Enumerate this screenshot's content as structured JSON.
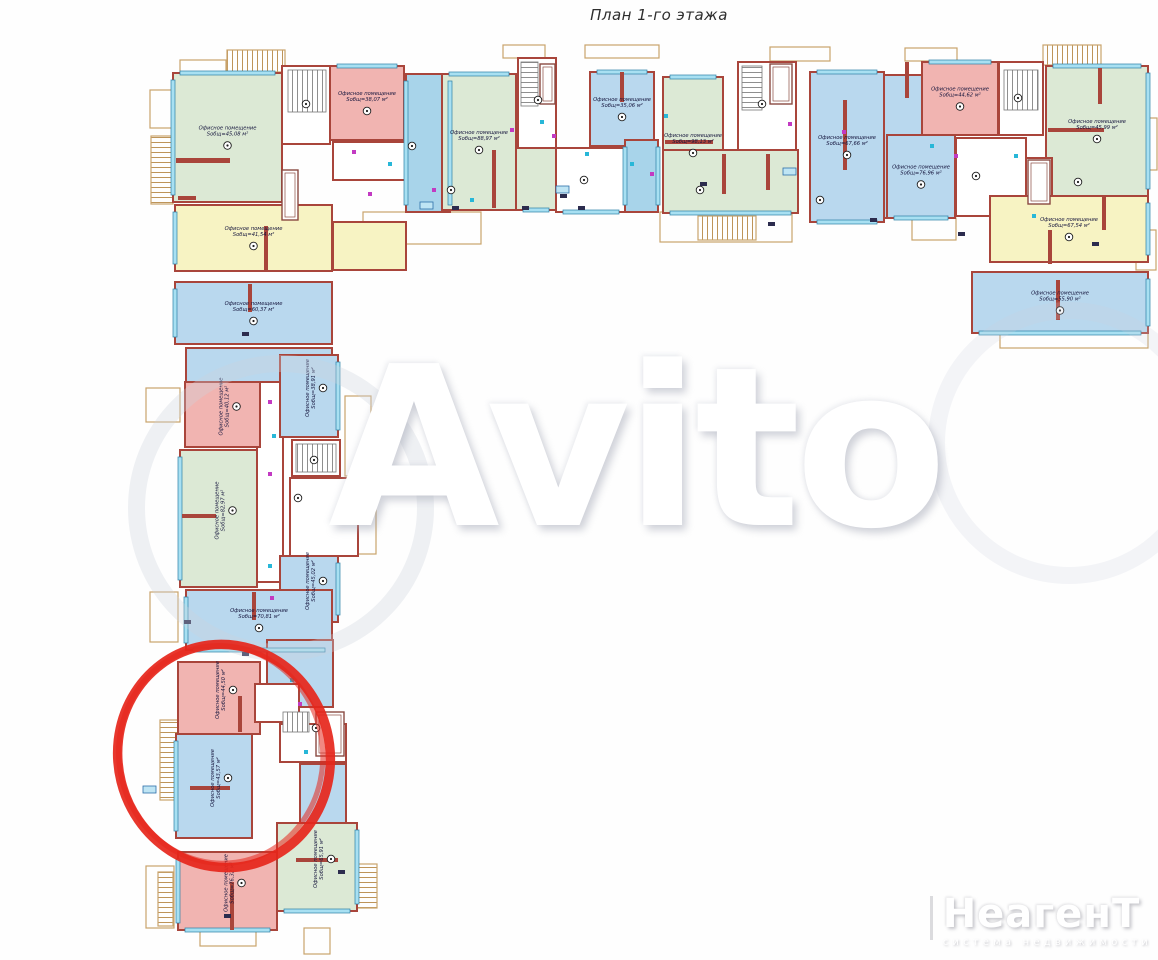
{
  "title": "План 1-го этажа",
  "watermark": {
    "text": "Avito"
  },
  "logo": {
    "brand": "НеагенТ",
    "subtitle": "система недвижимости"
  },
  "labels": {
    "room_type": "Офисное помещение",
    "area_prefix": "Sобщ=",
    "area_suffix": " м²"
  },
  "palette": {
    "wall": "#a9453b",
    "tan": "#c9a36b",
    "window": "#a8e0f2",
    "windowEdge": "#2d7fa6",
    "green": "#dce9d5",
    "blue": "#b9d8ee",
    "gal": "#a8d4ea",
    "pink": "#f1b4b1",
    "yellow": "#f7f3c3",
    "white": "#ffffff",
    "fix1": "#c23ac2",
    "fix2": "#28b7d8",
    "annotation": "#e6261b"
  },
  "plan": {
    "rooms": [
      {
        "id": "g1",
        "x": 173,
        "y": 73,
        "w": 109,
        "h": 129,
        "c": "green",
        "area": "45,08",
        "win": [
          "left",
          "top"
        ]
      },
      {
        "id": "y1",
        "x": 175,
        "y": 205,
        "w": 157,
        "h": 66,
        "c": "yellow",
        "area": "41,54",
        "win": [
          "left"
        ]
      },
      {
        "id": "core1",
        "x": 282,
        "y": 66,
        "w": 48,
        "h": 78,
        "c": "white"
      },
      {
        "id": "wc1",
        "x": 333,
        "y": 142,
        "w": 72,
        "h": 38,
        "c": "white"
      },
      {
        "id": "y1b",
        "x": 333,
        "y": 222,
        "w": 73,
        "h": 48,
        "c": "yellow"
      },
      {
        "id": "p1",
        "x": 330,
        "y": 66,
        "w": 74,
        "h": 74,
        "c": "pink",
        "area": "38,07",
        "win": [
          "top"
        ]
      },
      {
        "id": "gal1",
        "x": 406,
        "y": 74,
        "w": 44,
        "h": 138,
        "c": "gal",
        "win": [
          "left",
          "right"
        ]
      },
      {
        "id": "g2",
        "x": 442,
        "y": 74,
        "w": 74,
        "h": 136,
        "c": "green",
        "area": "88,97",
        "win": [
          "top"
        ]
      },
      {
        "id": "g2b",
        "x": 516,
        "y": 148,
        "w": 40,
        "h": 62,
        "c": "green",
        "win": [
          "bottom"
        ]
      },
      {
        "id": "core2",
        "x": 518,
        "y": 58,
        "w": 38,
        "h": 90,
        "c": "white"
      },
      {
        "id": "b2",
        "x": 590,
        "y": 72,
        "w": 64,
        "h": 74,
        "c": "blue",
        "area": "35,06",
        "win": [
          "top"
        ]
      },
      {
        "id": "h2",
        "x": 556,
        "y": 148,
        "w": 70,
        "h": 64,
        "c": "white",
        "win": [
          "bottom"
        ]
      },
      {
        "id": "gal2",
        "x": 625,
        "y": 140,
        "w": 33,
        "h": 72,
        "c": "gal",
        "win": [
          "left",
          "right"
        ]
      },
      {
        "id": "g3",
        "x": 663,
        "y": 77,
        "w": 60,
        "h": 136,
        "c": "green",
        "area": "98,13",
        "win": [
          "top"
        ]
      },
      {
        "id": "g3b",
        "x": 663,
        "y": 150,
        "w": 135,
        "h": 63,
        "c": "green",
        "win": [
          "bottom"
        ]
      },
      {
        "id": "core3",
        "x": 738,
        "y": 62,
        "w": 58,
        "h": 88,
        "c": "white"
      },
      {
        "id": "b3",
        "x": 810,
        "y": 72,
        "w": 74,
        "h": 150,
        "c": "blue",
        "area": "67,66",
        "win": [
          "top",
          "bottom"
        ]
      },
      {
        "id": "b4a",
        "x": 884,
        "y": 75,
        "w": 38,
        "h": 143,
        "c": "blue"
      },
      {
        "id": "b4",
        "x": 887,
        "y": 135,
        "w": 68,
        "h": 83,
        "c": "blue",
        "area": "76,96",
        "win": [
          "bottom"
        ]
      },
      {
        "id": "p2",
        "x": 922,
        "y": 62,
        "w": 76,
        "h": 73,
        "c": "pink",
        "area": "44,62",
        "win": [
          "top"
        ]
      },
      {
        "id": "core4",
        "x": 999,
        "y": 62,
        "w": 44,
        "h": 73,
        "c": "white"
      },
      {
        "id": "w4",
        "x": 956,
        "y": 138,
        "w": 70,
        "h": 78,
        "c": "white"
      },
      {
        "id": "g4",
        "x": 1046,
        "y": 66,
        "w": 102,
        "h": 130,
        "c": "green",
        "area": "45,99",
        "win": [
          "top",
          "right"
        ]
      },
      {
        "id": "core4b",
        "x": 1026,
        "y": 158,
        "w": 26,
        "h": 50,
        "c": "white"
      },
      {
        "id": "y2",
        "x": 990,
        "y": 196,
        "w": 158,
        "h": 66,
        "c": "yellow",
        "area": "67,54",
        "win": [
          "right"
        ]
      },
      {
        "id": "b5",
        "x": 972,
        "y": 272,
        "w": 176,
        "h": 61,
        "c": "blue",
        "area": "55,90",
        "win": [
          "bottom",
          "right"
        ]
      },
      {
        "id": "bw1",
        "x": 175,
        "y": 282,
        "w": 157,
        "h": 62,
        "c": "blue",
        "area": "60,37",
        "win": [
          "left"
        ]
      },
      {
        "id": "bw2",
        "x": 186,
        "y": 348,
        "w": 146,
        "h": 34,
        "c": "blue"
      },
      {
        "id": "colw",
        "x": 257,
        "y": 382,
        "w": 26,
        "h": 200,
        "c": "white"
      },
      {
        "id": "pw1",
        "x": 185,
        "y": 382,
        "w": 75,
        "h": 65,
        "c": "pink",
        "area": "40,12",
        "rot": true
      },
      {
        "id": "bw3",
        "x": 280,
        "y": 355,
        "w": 58,
        "h": 82,
        "c": "blue",
        "area": "38,91",
        "rot": true,
        "win": [
          "right"
        ]
      },
      {
        "id": "corew1",
        "x": 292,
        "y": 440,
        "w": 48,
        "h": 36,
        "c": "white"
      },
      {
        "id": "gw1",
        "x": 180,
        "y": 450,
        "w": 77,
        "h": 137,
        "c": "green",
        "area": "82,97",
        "rot": true,
        "win": [
          "left"
        ]
      },
      {
        "id": "ww1",
        "x": 290,
        "y": 478,
        "w": 68,
        "h": 78,
        "c": "white"
      },
      {
        "id": "bw4",
        "x": 280,
        "y": 556,
        "w": 58,
        "h": 66,
        "c": "blue",
        "area": "45,02",
        "rot": true,
        "win": [
          "right"
        ]
      },
      {
        "id": "bw5",
        "x": 186,
        "y": 590,
        "w": 146,
        "h": 60,
        "c": "blue",
        "area": "70,81",
        "win": [
          "left",
          "bottom"
        ]
      },
      {
        "id": "bw7",
        "x": 267,
        "y": 640,
        "w": 66,
        "h": 67,
        "c": "blue"
      },
      {
        "id": "pw2",
        "x": 178,
        "y": 662,
        "w": 82,
        "h": 72,
        "c": "pink",
        "area": "44,50",
        "rot": true
      },
      {
        "id": "wc2",
        "x": 255,
        "y": 684,
        "w": 44,
        "h": 38,
        "c": "white"
      },
      {
        "id": "corew2",
        "x": 280,
        "y": 724,
        "w": 66,
        "h": 38,
        "c": "white"
      },
      {
        "id": "bw6",
        "x": 176,
        "y": 734,
        "w": 76,
        "h": 104,
        "c": "blue",
        "area": "43,57",
        "rot": true,
        "win": [
          "left"
        ]
      },
      {
        "id": "bw8",
        "x": 300,
        "y": 764,
        "w": 46,
        "h": 76,
        "c": "blue"
      },
      {
        "id": "gw2",
        "x": 277,
        "y": 823,
        "w": 80,
        "h": 88,
        "c": "green",
        "area": "65,91",
        "rot": true,
        "win": [
          "right",
          "bottom"
        ]
      },
      {
        "id": "pw3",
        "x": 178,
        "y": 852,
        "w": 99,
        "h": 78,
        "c": "pink",
        "area": "76,32",
        "rot": true,
        "win": [
          "left",
          "bottom"
        ]
      }
    ],
    "stubs": [
      [
        176,
        158,
        54,
        5
      ],
      [
        178,
        196,
        18,
        4
      ],
      [
        264,
        226,
        4,
        44
      ],
      [
        492,
        150,
        4,
        58
      ],
      [
        665,
        140,
        48,
        4
      ],
      [
        722,
        154,
        4,
        40
      ],
      [
        766,
        154,
        4,
        36
      ],
      [
        843,
        100,
        4,
        70
      ],
      [
        1048,
        128,
        56,
        4
      ],
      [
        1098,
        68,
        4,
        36
      ],
      [
        1048,
        230,
        4,
        34
      ],
      [
        1102,
        196,
        4,
        34
      ],
      [
        1056,
        280,
        4,
        40
      ],
      [
        248,
        284,
        4,
        28
      ],
      [
        182,
        514,
        34,
        4
      ],
      [
        252,
        592,
        4,
        28
      ],
      [
        238,
        696,
        4,
        36
      ],
      [
        190,
        786,
        40,
        4
      ],
      [
        230,
        882,
        4,
        48
      ],
      [
        296,
        858,
        42,
        4
      ],
      [
        905,
        62,
        4,
        36
      ],
      [
        620,
        72,
        4,
        30
      ]
    ],
    "balconies": [
      {
        "x": 180,
        "y": 60,
        "w": 46,
        "h": 12
      },
      {
        "x": 227,
        "y": 50,
        "w": 58,
        "h": 22,
        "hatch": "v"
      },
      {
        "x": 150,
        "y": 90,
        "w": 30,
        "h": 38
      },
      {
        "x": 151,
        "y": 136,
        "w": 22,
        "h": 68,
        "hatch": "h"
      },
      {
        "x": 503,
        "y": 45,
        "w": 42,
        "h": 13
      },
      {
        "x": 585,
        "y": 45,
        "w": 74,
        "h": 13
      },
      {
        "x": 770,
        "y": 47,
        "w": 60,
        "h": 14
      },
      {
        "x": 905,
        "y": 48,
        "w": 52,
        "h": 13
      },
      {
        "x": 1043,
        "y": 45,
        "w": 58,
        "h": 20,
        "hatch": "v"
      },
      {
        "x": 1148,
        "y": 118,
        "w": 9,
        "h": 52
      },
      {
        "x": 1136,
        "y": 230,
        "w": 20,
        "h": 40
      },
      {
        "x": 363,
        "y": 212,
        "w": 118,
        "h": 32
      },
      {
        "x": 660,
        "y": 212,
        "w": 132,
        "h": 30
      },
      {
        "x": 698,
        "y": 216,
        "w": 58,
        "h": 24,
        "hatch": "v"
      },
      {
        "x": 1000,
        "y": 333,
        "w": 148,
        "h": 15
      },
      {
        "x": 912,
        "y": 218,
        "w": 44,
        "h": 22
      },
      {
        "x": 146,
        "y": 388,
        "w": 34,
        "h": 34
      },
      {
        "x": 345,
        "y": 396,
        "w": 26,
        "h": 80
      },
      {
        "x": 150,
        "y": 592,
        "w": 28,
        "h": 50
      },
      {
        "x": 160,
        "y": 720,
        "w": 22,
        "h": 80,
        "hatch": "h"
      },
      {
        "x": 146,
        "y": 866,
        "w": 28,
        "h": 62
      },
      {
        "x": 158,
        "y": 872,
        "w": 15,
        "h": 54,
        "hatch": "h"
      },
      {
        "x": 357,
        "y": 864,
        "w": 20,
        "h": 44,
        "hatch": "h"
      },
      {
        "x": 304,
        "y": 928,
        "w": 26,
        "h": 26
      },
      {
        "x": 200,
        "y": 930,
        "w": 56,
        "h": 16
      },
      {
        "x": 340,
        "y": 490,
        "w": 36,
        "h": 64
      }
    ],
    "stairs": [
      {
        "x": 288,
        "y": 70,
        "w": 38,
        "h": 42,
        "p": "v"
      },
      {
        "x": 521,
        "y": 62,
        "w": 17,
        "h": 44,
        "p": "h"
      },
      {
        "x": 742,
        "y": 66,
        "w": 20,
        "h": 44,
        "p": "h"
      },
      {
        "x": 1004,
        "y": 70,
        "w": 34,
        "h": 40,
        "p": "v"
      },
      {
        "x": 296,
        "y": 444,
        "w": 40,
        "h": 28,
        "p": "v"
      },
      {
        "x": 283,
        "y": 712,
        "w": 26,
        "h": 20,
        "p": "v"
      }
    ],
    "elevators": [
      {
        "x": 540,
        "y": 64,
        "w": 15,
        "h": 40
      },
      {
        "x": 770,
        "y": 64,
        "w": 22,
        "h": 40
      },
      {
        "x": 1028,
        "y": 160,
        "w": 22,
        "h": 44
      },
      {
        "x": 282,
        "y": 170,
        "w": 16,
        "h": 50
      },
      {
        "x": 316,
        "y": 712,
        "w": 28,
        "h": 44
      }
    ],
    "fixtures": [
      [
        352,
        150
      ],
      [
        388,
        162
      ],
      [
        368,
        192
      ],
      [
        540,
        120
      ],
      [
        552,
        134
      ],
      [
        630,
        162
      ],
      [
        650,
        172
      ],
      [
        664,
        114
      ],
      [
        788,
        122
      ],
      [
        930,
        144
      ],
      [
        954,
        154
      ],
      [
        1014,
        154
      ],
      [
        268,
        400
      ],
      [
        272,
        434
      ],
      [
        268,
        472
      ],
      [
        268,
        564
      ],
      [
        270,
        596
      ],
      [
        290,
        678
      ],
      [
        298,
        702
      ],
      [
        304,
        750
      ],
      [
        432,
        188
      ],
      [
        470,
        198
      ],
      [
        842,
        130
      ],
      [
        1032,
        214
      ],
      [
        510,
        128
      ],
      [
        585,
        152
      ]
    ],
    "tags": [
      [
        452,
        206
      ],
      [
        578,
        206
      ],
      [
        700,
        182
      ],
      [
        1092,
        242
      ],
      [
        242,
        332
      ],
      [
        242,
        652
      ],
      [
        224,
        914
      ],
      [
        338,
        870
      ],
      [
        870,
        218
      ],
      [
        560,
        194
      ],
      [
        768,
        222
      ],
      [
        184,
        620
      ],
      [
        522,
        206
      ],
      [
        958,
        232
      ]
    ],
    "bluetags": [
      [
        143,
        786
      ],
      [
        420,
        202
      ],
      [
        783,
        168
      ],
      [
        556,
        186
      ]
    ],
    "extra_markers": [
      [
        306,
        104
      ],
      [
        538,
        100
      ],
      [
        762,
        104
      ],
      [
        1018,
        98
      ],
      [
        314,
        460
      ],
      [
        316,
        728
      ],
      [
        584,
        180
      ],
      [
        976,
        176
      ],
      [
        1078,
        182
      ],
      [
        412,
        146
      ],
      [
        298,
        498
      ],
      [
        451,
        190
      ],
      [
        820,
        200
      ],
      [
        700,
        190
      ]
    ],
    "annotation": {
      "cx": 224,
      "cy": 756,
      "rx": 106,
      "ry": 112,
      "rot": -14,
      "width": 9.5
    }
  }
}
